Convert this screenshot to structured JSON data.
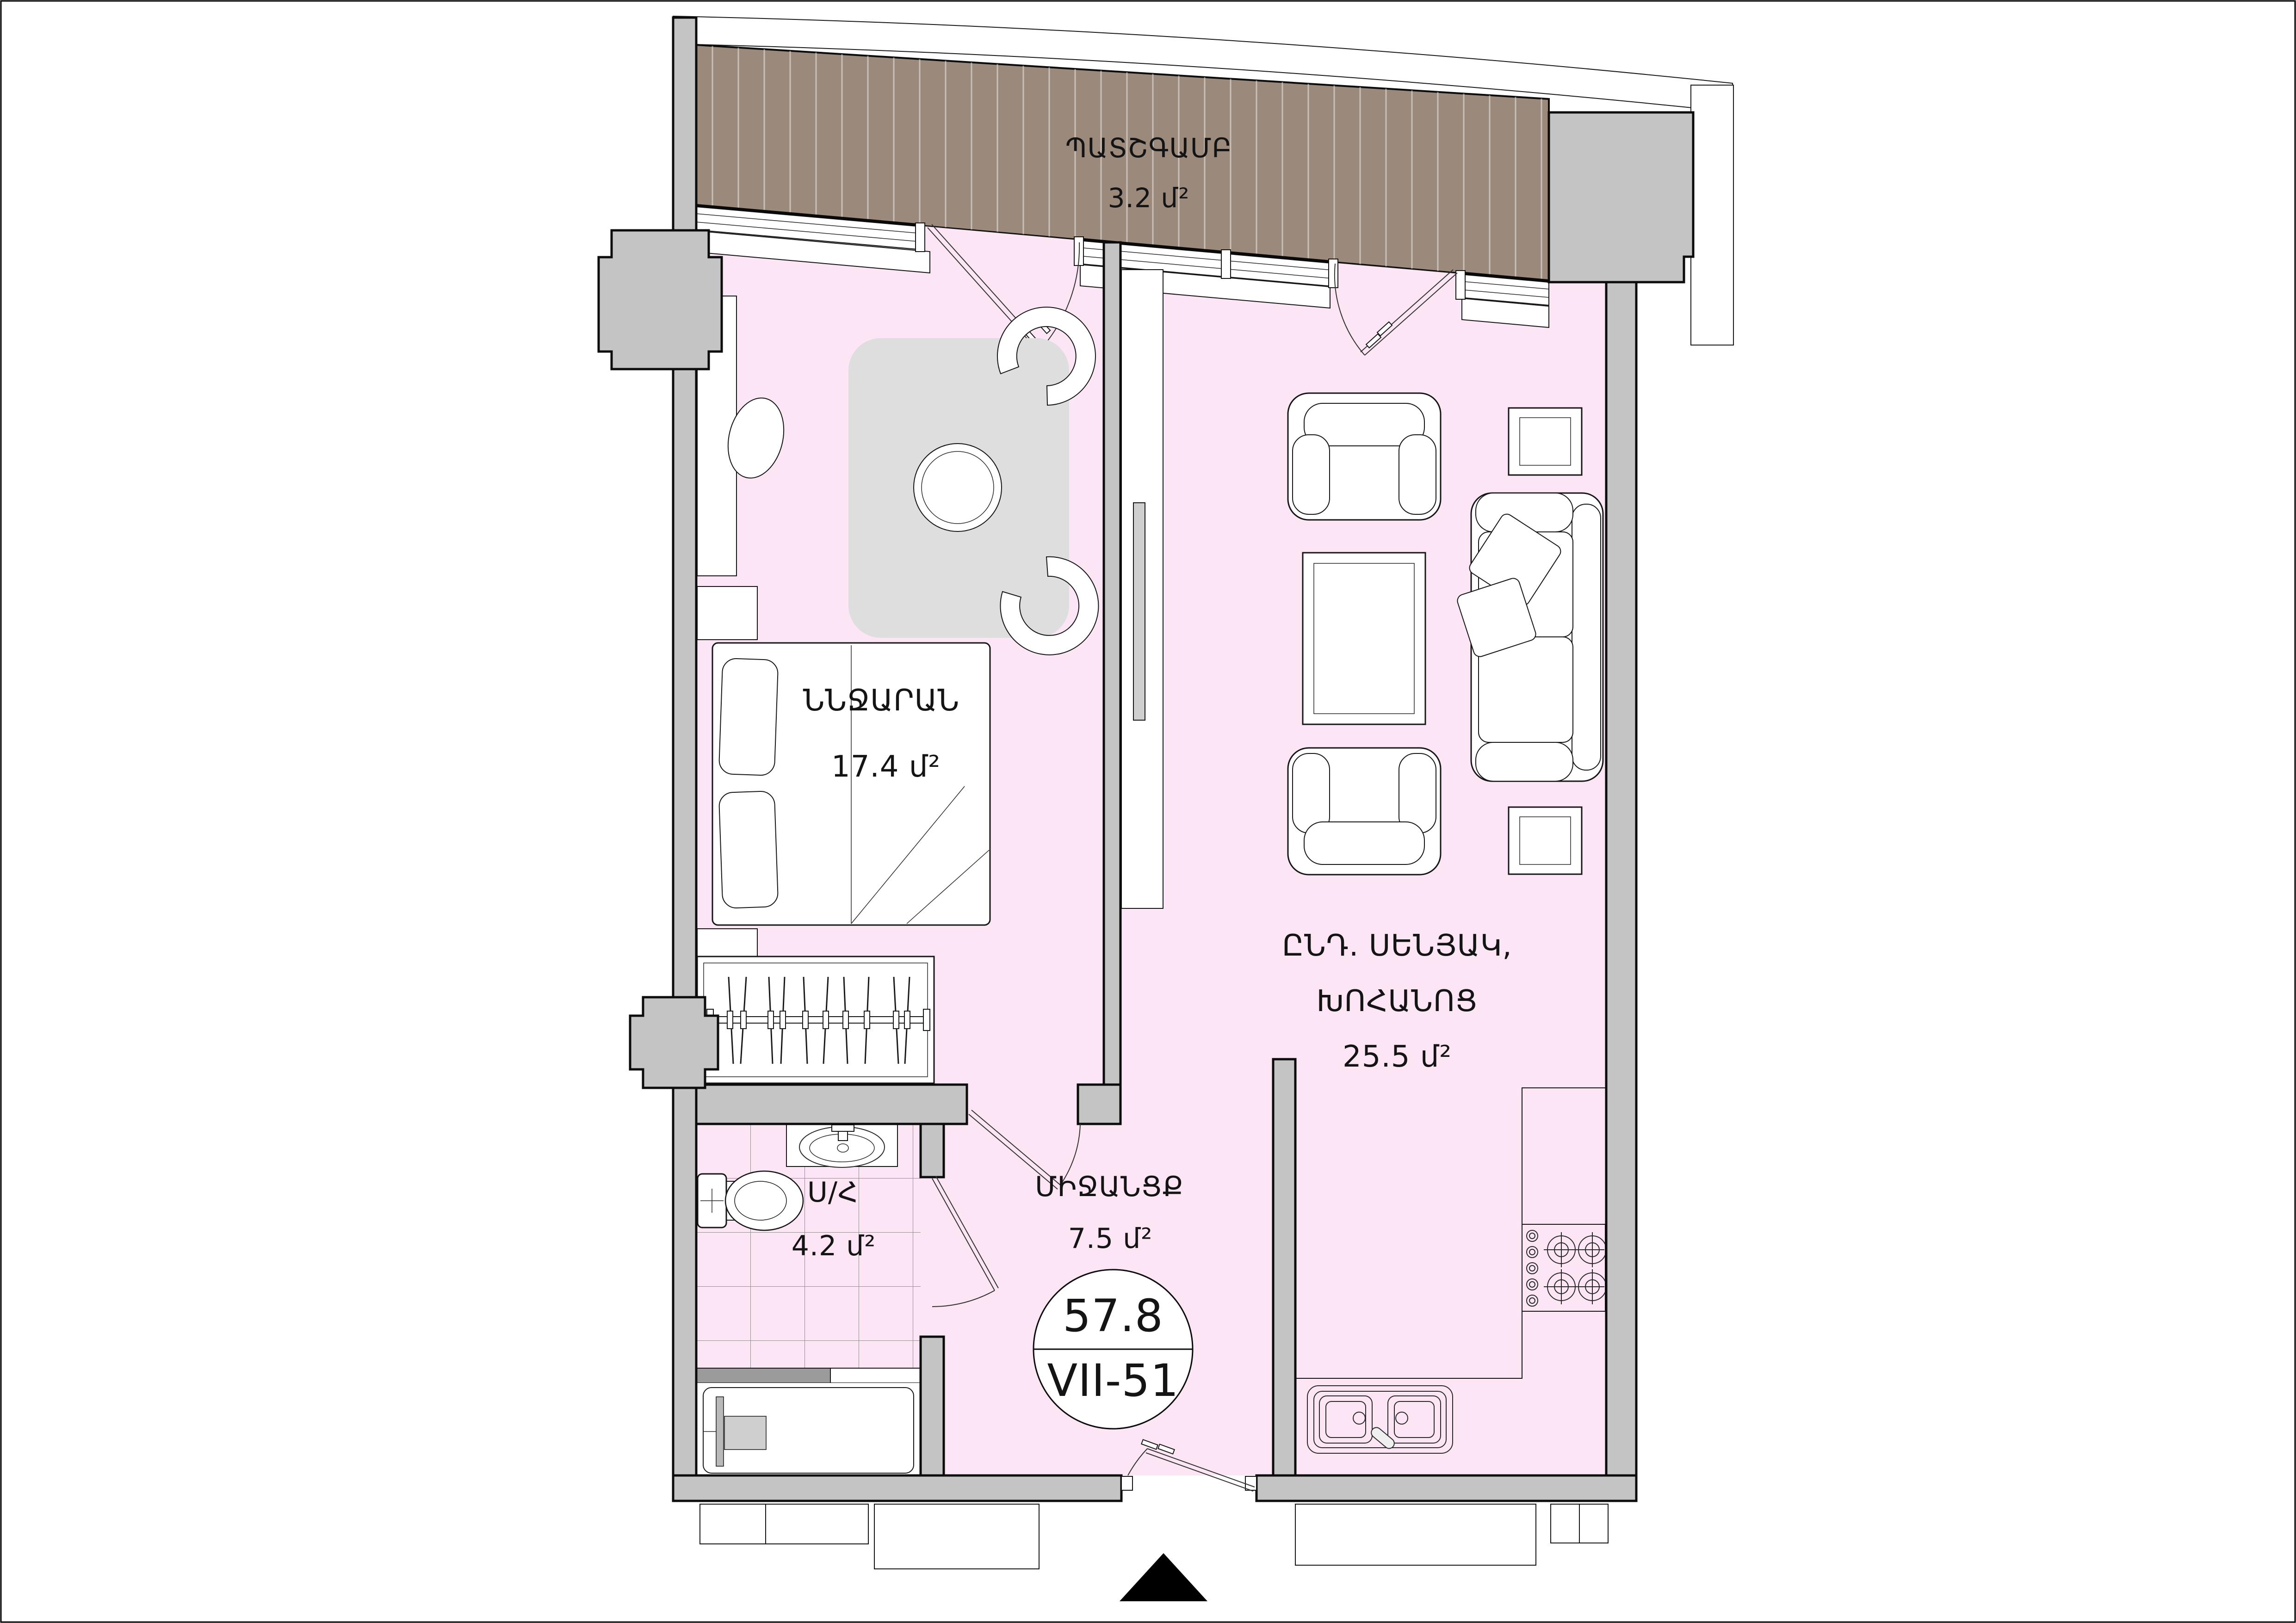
{
  "colors": {
    "floor_pink": "#fce6f6",
    "balcony_brown": "#9b8a7b",
    "wall_gray": "#c4c4c4",
    "rug_gray": "#dedede",
    "tile_line": "#8f8f8f",
    "threshold_dark": "#9b9b9b",
    "outline_black": "#0c0c0c",
    "badge_fill": "#ffffff"
  },
  "rooms": {
    "balcony": {
      "name": "ՊԱՏՇԳԱՄԲ",
      "area": "3.2 մ²"
    },
    "bedroom": {
      "name": "ՆՆՋԱՐԱՆ",
      "area": "17.4 մ²"
    },
    "living_kitchen": {
      "name_line1": "ԸՆԴ. ՍԵՆՅԱԿ,",
      "name_line2": "ԽՈՀԱՆՈՑ",
      "area": "25.5 մ²"
    },
    "bathroom": {
      "name": "Ս/Հ",
      "area": "4.2 մ²"
    },
    "hallway": {
      "name": "ՄԻՋԱՆՑՔ",
      "area": "7.5 մ²"
    }
  },
  "unit_badge": {
    "total_area": "57.8",
    "unit_number": "VII-51"
  }
}
